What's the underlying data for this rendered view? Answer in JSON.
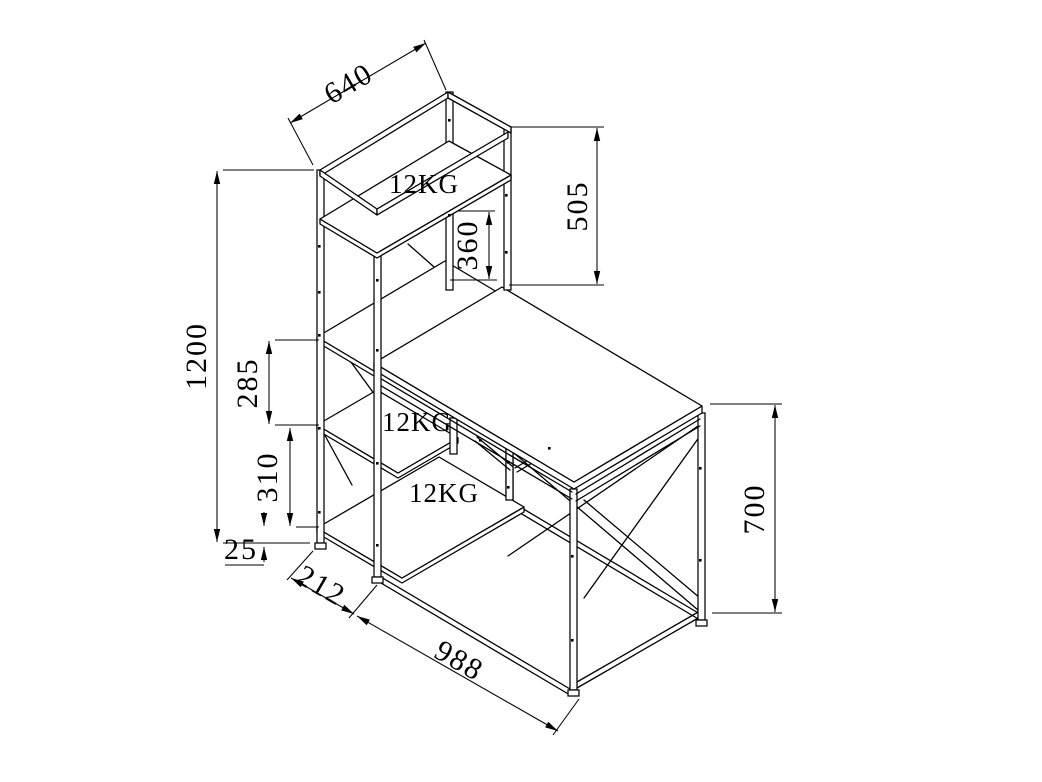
{
  "drawing": {
    "title": "desk-with-shelf-tower-dimension-drawing",
    "colors": {
      "line": "#000000",
      "background": "#ffffff"
    },
    "load_labels": {
      "top_shelf": "12KG",
      "middle_shelf": "12KG",
      "bottom_shelf": "12KG"
    },
    "dimensions": {
      "top_shelf_depth": "640",
      "hutch_height": "505",
      "desk_to_top_shelf": "360",
      "total_height": "1200",
      "upper_shelf_gap": "285",
      "lower_shelf_gap": "310",
      "base_clearance": "25",
      "tower_width": "212",
      "desk_length": "988",
      "desk_height": "700"
    }
  }
}
